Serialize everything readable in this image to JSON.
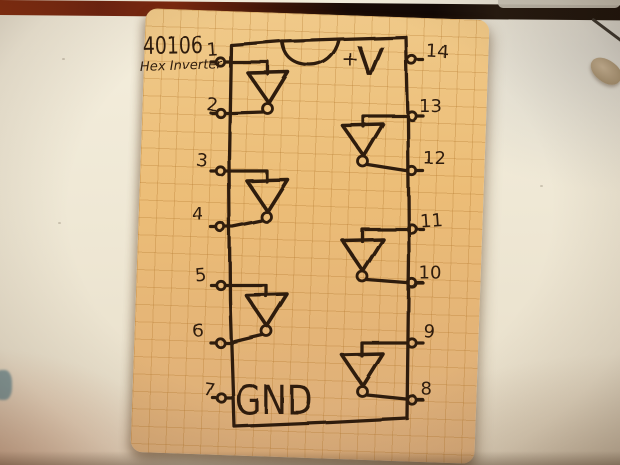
{
  "scene": {
    "description": "Hand-drawn pinout diagram of a 40106 hex inverter IC, drawn in dark ink on tan graph paper, photographed lying on a pale desk with a dark wooden shelf strip at top and a pencil tip at the right edge"
  },
  "diagram": {
    "part_number": "40106",
    "part_name": "Hex Inverter",
    "power_plus": "+",
    "power_v": "V",
    "ground_label": "GND",
    "pins": {
      "left": [
        "1",
        "2",
        "3",
        "4",
        "5",
        "6",
        "7"
      ],
      "right": [
        "14",
        "13",
        "12",
        "11",
        "10",
        "9",
        "8"
      ]
    },
    "gates": [
      {
        "side": "left",
        "input_pin": "1",
        "output_pin": "2"
      },
      {
        "side": "left",
        "input_pin": "3",
        "output_pin": "4"
      },
      {
        "side": "left",
        "input_pin": "5",
        "output_pin": "6"
      },
      {
        "side": "right",
        "input_pin": "13",
        "output_pin": "12"
      },
      {
        "side": "right",
        "input_pin": "11",
        "output_pin": "10"
      },
      {
        "side": "right",
        "input_pin": "9",
        "output_pin": "8"
      }
    ],
    "colors": {
      "ink": "#2f1c0f",
      "paper": "#ecbd77",
      "grid_line": "#c08a3e"
    }
  }
}
